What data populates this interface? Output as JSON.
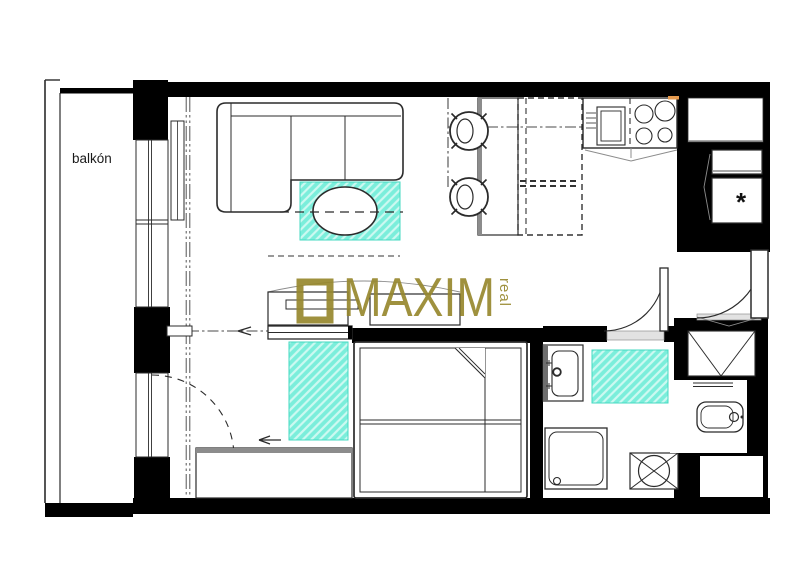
{
  "labels": {
    "balcony": "balkón",
    "appliance_mark": "*"
  },
  "brand": {
    "name": "MAXIM",
    "suffix": "real",
    "logo_icon": "square-outline-icon"
  },
  "colors": {
    "wall": "#000000",
    "line": "#2b2b2b",
    "gray": "#8c8c8c",
    "rug_fill": "#7beedb",
    "rug_stroke": "#45d9c2",
    "brand_olive": "#97882e",
    "accent_orange": "#e59a4e",
    "threshold": "#e2e2e2"
  },
  "plan_elements": [
    "balcony",
    "living-room-sofa",
    "coffee-table",
    "living-room-rug",
    "dining-table",
    "dining-chair",
    "dining-chair",
    "kitchen-counter",
    "kitchen-sink",
    "cooktop-4-burners",
    "appliance-cabinet",
    "tv-cabinet",
    "sliding-partition-door",
    "double-bed",
    "bedroom-rug",
    "wardrobe",
    "bathroom-washbasin",
    "shower",
    "washing-machine",
    "bathroom-rug",
    "toilet",
    "hall-closet",
    "entrance-door",
    "bathroom-door",
    "balcony-door",
    "windows",
    "curtain-track",
    "radiator"
  ]
}
